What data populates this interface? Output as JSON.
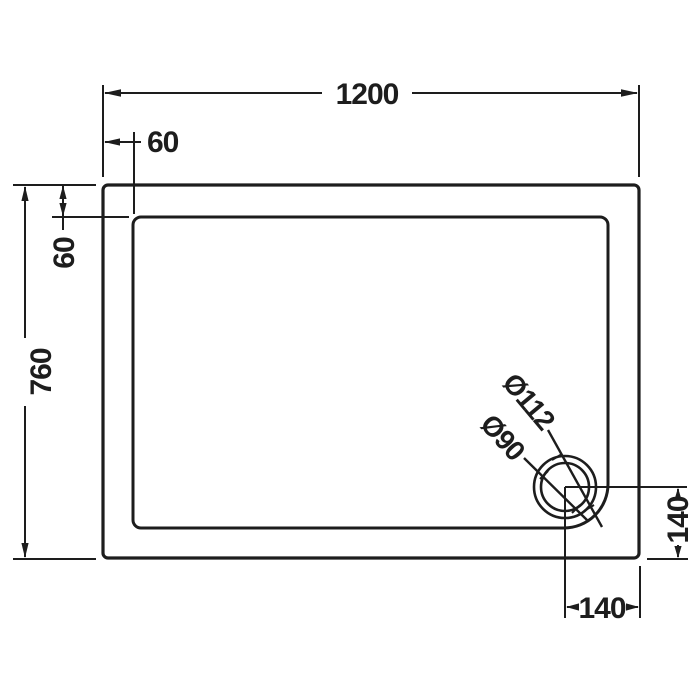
{
  "drawing": {
    "labels": {
      "overall_width": "1200",
      "overall_depth": "760",
      "rim_offset_left": "60",
      "rim_offset_top": "60",
      "waste_outer_diameter": "Ø112",
      "waste_bowl_diameter": "Ø90",
      "waste_offset_from_bottom": "140",
      "waste_offset_from_right": "140"
    },
    "colors": {
      "line": "#1d1d1d",
      "background": "#ffffff"
    }
  }
}
